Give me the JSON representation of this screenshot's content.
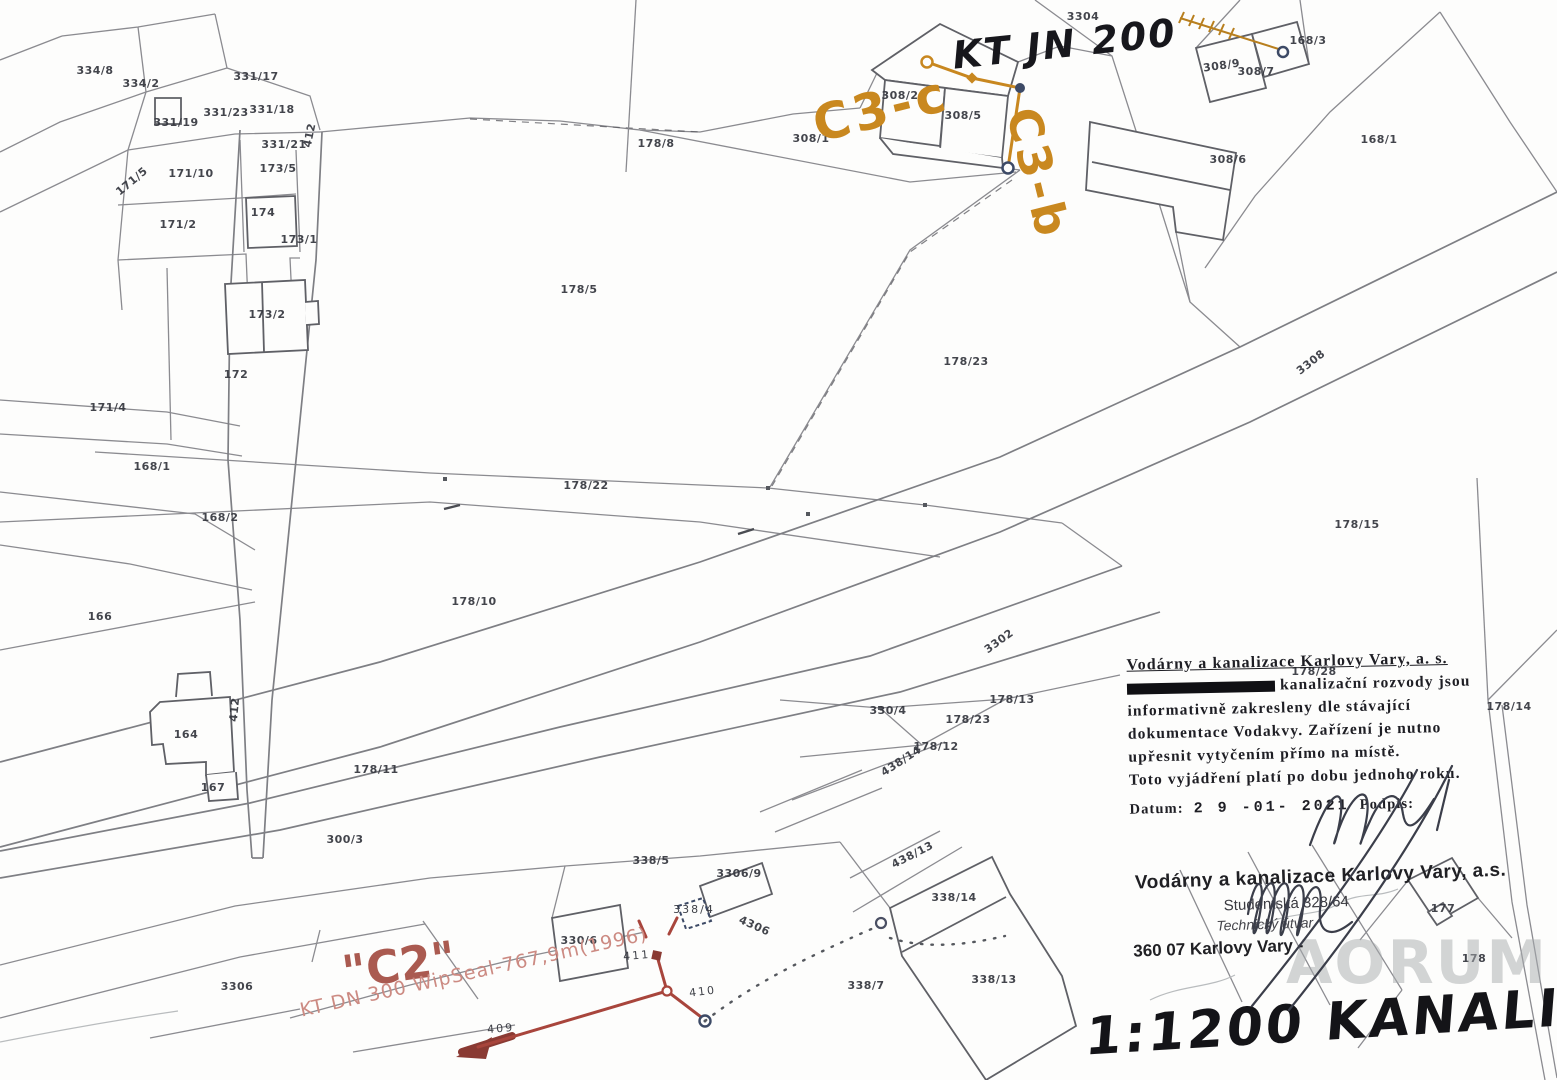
{
  "annotations": {
    "kt_jn": "KT JN 200",
    "c3c": "C3-c",
    "c3b": "C3-b",
    "c2": "\"C2\"",
    "kt_dn": "KT DN 300 WipSeal-767,9m(1996)",
    "scale_note": "1:1200 KANALIZACE",
    "watermark": "AORUM"
  },
  "stamp_top": {
    "header": "Vodárny a kanalizace Karlovy Vary, a. s.",
    "line2": "kanalizační rozvody jsou",
    "line3": "informativně zakresleny dle stávající",
    "line4": "dokumentace Vodakvy. Zařízení je nutno",
    "line5": "upřesnit vytyčením přímo na místě.",
    "line6": "Toto vyjádření platí po dobu jednoho roku.",
    "date_label": "Datum:",
    "date_value": "2 9  -01-  2021",
    "signature_label": "Podpis:"
  },
  "stamp_bottom": {
    "header": "Vodárny a kanalizace Karlovy Vary, a.s.",
    "address1": "Studentská 328/64",
    "address2": "Technický útvar",
    "address3": "360 07 Karlovy Vary -"
  },
  "map": {
    "line_color": "#8b8b90",
    "sewer_red_color": "#a8453c",
    "sewer_orange_color": "#c8871f",
    "labels": [
      {
        "t": "334/8",
        "x": 95,
        "y": 74
      },
      {
        "t": "334/2",
        "x": 141,
        "y": 87,
        "s": 9
      },
      {
        "t": "331/17",
        "x": 256,
        "y": 80
      },
      {
        "t": "331/19",
        "x": 176,
        "y": 126,
        "s": 9
      },
      {
        "t": "331/23",
        "x": 226,
        "y": 116,
        "s": 9
      },
      {
        "t": "331/18",
        "x": 272,
        "y": 113
      },
      {
        "t": "331/21",
        "x": 284,
        "y": 148,
        "s": 9
      },
      {
        "t": "412",
        "x": 313,
        "y": 136,
        "r": -78,
        "s": 10
      },
      {
        "t": "171/5",
        "x": 134,
        "y": 184,
        "r": -40,
        "s": 9
      },
      {
        "t": "171/10",
        "x": 191,
        "y": 177,
        "s": 9
      },
      {
        "t": "173/5",
        "x": 278,
        "y": 172,
        "s": 10
      },
      {
        "t": "174",
        "x": 263,
        "y": 216
      },
      {
        "t": "171/2",
        "x": 178,
        "y": 228
      },
      {
        "t": "173/1",
        "x": 299,
        "y": 243,
        "s": 10
      },
      {
        "t": "173/2",
        "x": 267,
        "y": 318,
        "s": 9
      },
      {
        "t": "172",
        "x": 236,
        "y": 378
      },
      {
        "t": "171/4",
        "x": 108,
        "y": 411
      },
      {
        "t": "168/1",
        "x": 152,
        "y": 470
      },
      {
        "t": "168/2",
        "x": 220,
        "y": 521
      },
      {
        "t": "166",
        "x": 100,
        "y": 620,
        "s": 9
      },
      {
        "t": "412",
        "x": 238,
        "y": 710,
        "r": -84,
        "s": 10
      },
      {
        "t": "164",
        "x": 186,
        "y": 738,
        "s": 9
      },
      {
        "t": "167",
        "x": 213,
        "y": 791,
        "s": 9
      },
      {
        "t": "178/11",
        "x": 376,
        "y": 773,
        "s": 10
      },
      {
        "t": "300/3",
        "x": 345,
        "y": 843,
        "s": 10
      },
      {
        "t": "3306",
        "x": 237,
        "y": 990
      },
      {
        "t": "178/8",
        "x": 656,
        "y": 147
      },
      {
        "t": "308/1",
        "x": 811,
        "y": 142
      },
      {
        "t": "308/2",
        "x": 900,
        "y": 99,
        "s": 9
      },
      {
        "t": "308/5",
        "x": 963,
        "y": 119,
        "s": 9
      },
      {
        "t": "3304",
        "x": 1083,
        "y": 20,
        "s": 9
      },
      {
        "t": "308/9",
        "x": 1222,
        "y": 69,
        "r": -8,
        "s": 9
      },
      {
        "t": "308/7",
        "x": 1256,
        "y": 75,
        "s": 10
      },
      {
        "t": "168/3",
        "x": 1308,
        "y": 44,
        "s": 10
      },
      {
        "t": "308/6",
        "x": 1228,
        "y": 163,
        "s": 9
      },
      {
        "t": "168/1",
        "x": 1379,
        "y": 143,
        "s": 10
      },
      {
        "t": "178/5",
        "x": 579,
        "y": 293
      },
      {
        "t": "178/23",
        "x": 966,
        "y": 365
      },
      {
        "t": "178/22",
        "x": 586,
        "y": 489
      },
      {
        "t": "178/10",
        "x": 474,
        "y": 605
      },
      {
        "t": "3308",
        "x": 1313,
        "y": 365,
        "r": -38,
        "s": 10
      },
      {
        "t": "178/15",
        "x": 1357,
        "y": 528,
        "s": 10
      },
      {
        "t": "3302",
        "x": 1001,
        "y": 644,
        "r": -36,
        "s": 10
      },
      {
        "t": "330/4",
        "x": 888,
        "y": 714,
        "s": 9
      },
      {
        "t": "178/13",
        "x": 1012,
        "y": 703,
        "s": 9
      },
      {
        "t": "178/23",
        "x": 968,
        "y": 723,
        "s": 8
      },
      {
        "t": "178/12",
        "x": 936,
        "y": 750,
        "s": 9
      },
      {
        "t": "438/14",
        "x": 903,
        "y": 764,
        "r": -33,
        "s": 9
      },
      {
        "t": "178/28",
        "x": 1314,
        "y": 675,
        "s": 8
      },
      {
        "t": "178/14",
        "x": 1509,
        "y": 710,
        "s": 10
      },
      {
        "t": "177",
        "x": 1443,
        "y": 912,
        "s": 9
      },
      {
        "t": "178",
        "x": 1474,
        "y": 962,
        "s": 9
      },
      {
        "t": "338/5",
        "x": 651,
        "y": 864,
        "s": 9
      },
      {
        "t": "3306/9",
        "x": 739,
        "y": 877,
        "s": 8
      },
      {
        "t": "338/4",
        "x": 694,
        "y": 913,
        "s": 7,
        "c": "#3d4a66"
      },
      {
        "t": "4306",
        "x": 753,
        "y": 929,
        "r": 24,
        "s": 9
      },
      {
        "t": "438/13",
        "x": 914,
        "y": 858,
        "r": -27,
        "s": 9
      },
      {
        "t": "338/14",
        "x": 954,
        "y": 901,
        "s": 9
      },
      {
        "t": "338/7",
        "x": 866,
        "y": 989,
        "s": 9
      },
      {
        "t": "338/13",
        "x": 994,
        "y": 983,
        "s": 9
      },
      {
        "t": "330/6",
        "x": 579,
        "y": 944,
        "s": 9
      },
      {
        "t": "409",
        "x": 501,
        "y": 1032,
        "r": -5,
        "s": 21,
        "c": "#a8453c"
      },
      {
        "t": "410",
        "x": 703,
        "y": 995,
        "r": -7,
        "s": 21,
        "c": "#a8453c"
      },
      {
        "t": "411",
        "x": 637,
        "y": 959,
        "r": -5,
        "s": 17,
        "c": "#a8453c"
      }
    ]
  }
}
